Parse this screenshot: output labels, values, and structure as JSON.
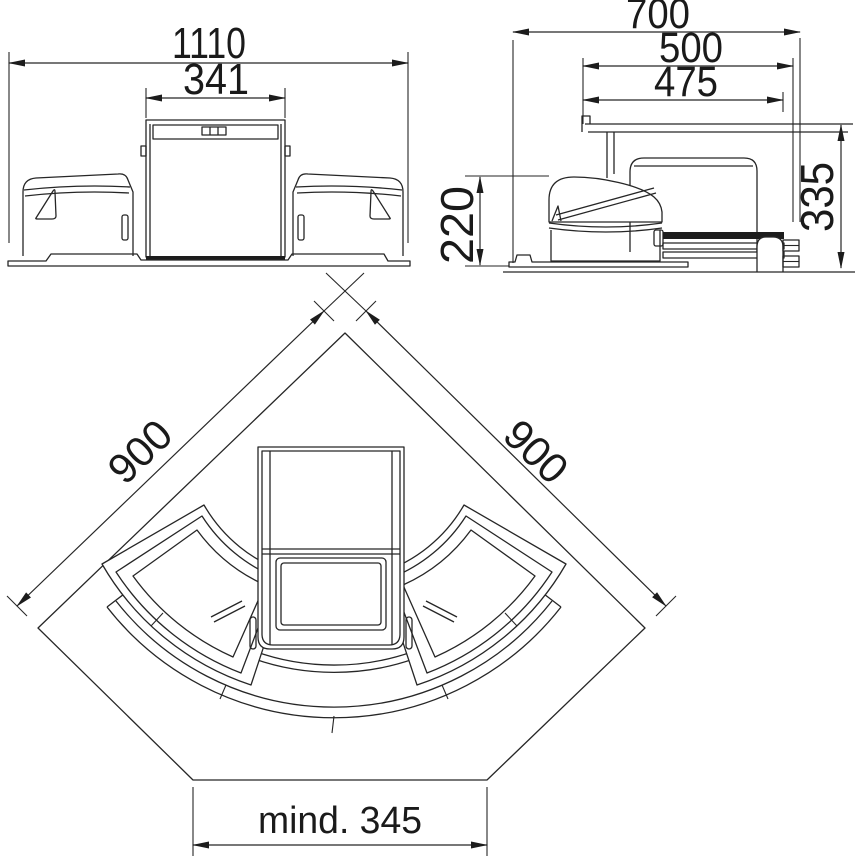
{
  "drawing": {
    "front_view": {
      "dim_overall_width": "1110",
      "dim_inner_width": "341"
    },
    "side_view": {
      "dim_overall_depth": "700",
      "dim_cutout_depth": "500",
      "dim_rail_depth": "475",
      "dim_bin_height": "220",
      "dim_total_height": "335"
    },
    "plan_view": {
      "dim_wall_left": "900",
      "dim_wall_right": "900",
      "dim_front_min": "mind. 345"
    },
    "colors": {
      "line": "#262626",
      "background": "#ffffff"
    }
  }
}
